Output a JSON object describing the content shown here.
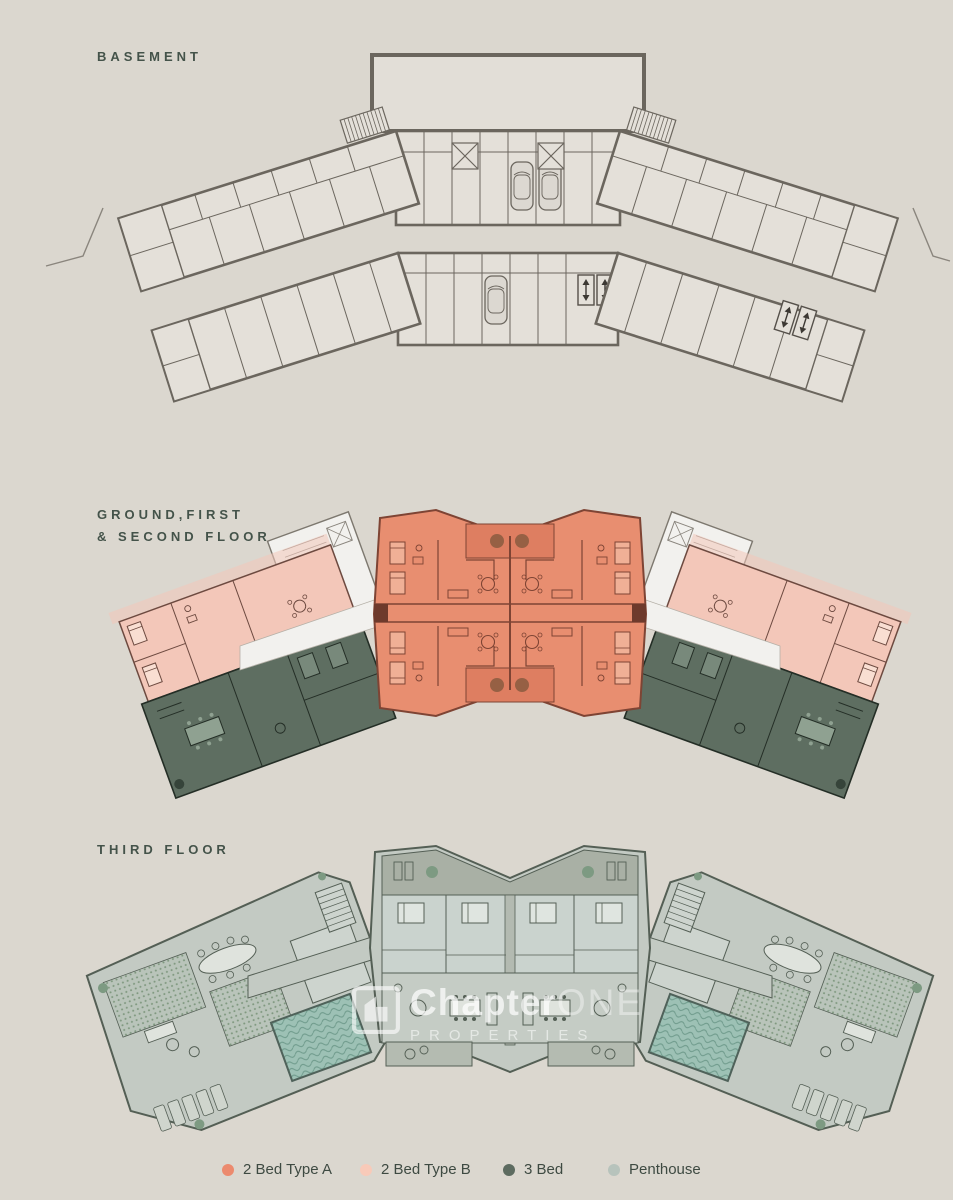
{
  "sections": {
    "basement": {
      "label": "BASEMENT"
    },
    "ground": {
      "label_line1": "GROUND,FIRST",
      "label_line2": "& SECOND FLOOR"
    },
    "third": {
      "label": "THIRD FLOOR"
    }
  },
  "watermark": {
    "brand_bold": "Chapter",
    "brand_light": "ONE",
    "subtitle": "PROPERTIES"
  },
  "legend": {
    "items": [
      {
        "label": "2 Bed Type A",
        "color": "#ec8a6e"
      },
      {
        "label": "2 Bed Type B",
        "color": "#f8cab9"
      },
      {
        "label": "3 Bed",
        "color": "#5d6b60"
      },
      {
        "label": "Penthouse",
        "color": "#b7c3bc"
      }
    ]
  },
  "plan_colors": {
    "two_bed_type_a": "#e88e70",
    "two_bed_type_b": "#f3c7b9",
    "three_bed": "#5e6e61",
    "penthouse": "#c3cac3",
    "basement_lines": "#6b665e"
  }
}
